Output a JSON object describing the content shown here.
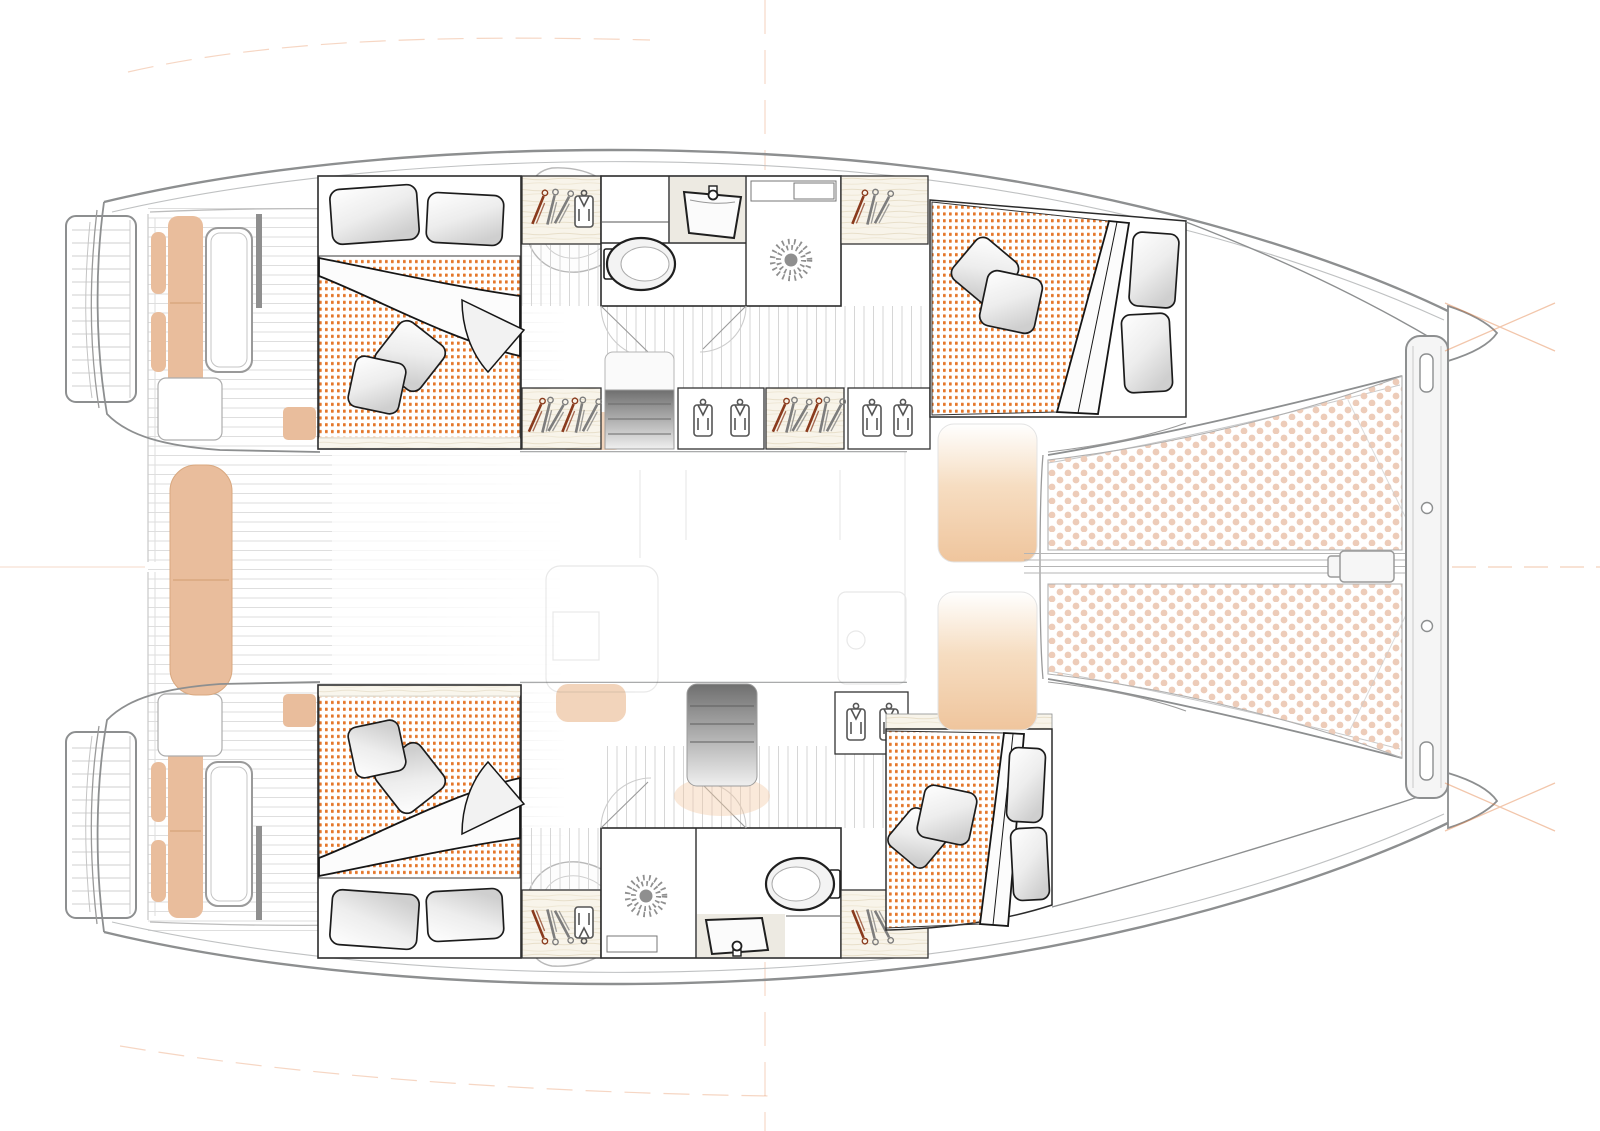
{
  "page": {
    "background": "#ffffff"
  },
  "plan": {
    "subject": "catamaran-interior-deck-plan",
    "view": "top-down",
    "bow_direction": "right",
    "areas": [
      "aft-swim-platforms",
      "aft-cockpit",
      "port-aft-cabin",
      "port-wardrobes",
      "port-bathroom",
      "port-companionway-stairs",
      "port-forward-cabin",
      "salon-faded",
      "foredeck-lounge",
      "trampoline",
      "bowsprit",
      "forward-beam",
      "starboard-aft-cabin",
      "starboard-bathroom",
      "starboard-companionway-stairs",
      "starboard-wardrobes",
      "starboard-forward-cabin"
    ],
    "icons": {
      "toilet": "oval-bowl-with-tank",
      "sink": "trapezoid-basin-with-faucet",
      "shower": "sunburst-drain",
      "wardrobe": "clothes-hangers-top-view",
      "locker": "hanging-shirt",
      "bed": "dotted-mattress-with-pillows-and-duvet",
      "trampoline": "dot-grid-net"
    }
  },
  "palette": {
    "hull_outline": "#8d8f90",
    "hull_inner_line": "#bfc1c2",
    "wall_dark": "#2b2b2b",
    "fixture_dark": "#1f1f1f",
    "plank_line": "#dedede",
    "corridor_line": "#d6d6d6",
    "wood_base": "#f8f4ea",
    "mattress_dot": "#e4772b",
    "trampoline_dot": "#edccb9",
    "cushion": "#e9bd9c",
    "cushion_seam": "#d9a87f",
    "stair_top": "#6f6f6f",
    "stair_bottom": "#efefef",
    "pad_top": "#ffffff",
    "pad_mid": "#f6ddc1",
    "pad_bottom": "#efc59d",
    "reference_orange": "#e07838",
    "glow_tan": "#f2c9a2"
  }
}
